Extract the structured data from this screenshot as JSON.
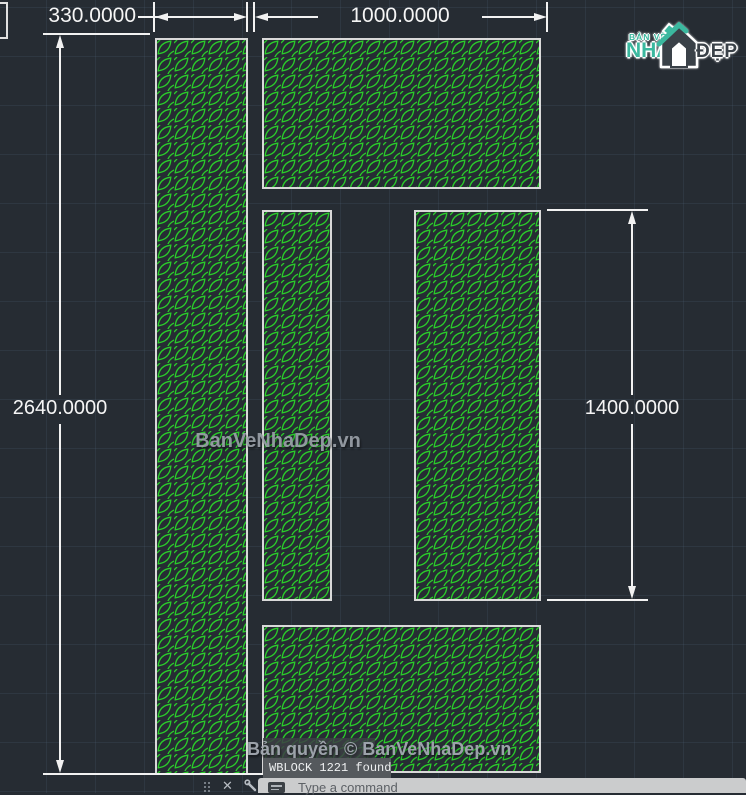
{
  "dimensions": {
    "d330": "330.0000",
    "d1000": "1000.0000",
    "d2640": "2640.0000",
    "d1400": "1400.0000"
  },
  "watermark": {
    "center": "BanVeNhaDep.vn",
    "copyright": "Bản quyền © BanVeNhaDep.vn"
  },
  "logo": {
    "top": "BẢN VẼ",
    "main": "NHÀ",
    "suffix": "ĐẸP"
  },
  "command_line": {
    "history": "WBLOCK 1221 found",
    "placeholder": "Type a command",
    "close_glyph": "✕"
  },
  "colors": {
    "canvas_bg": "#262c33",
    "leaf_green": "#2acc2a",
    "panel_border": "#d9d9d9",
    "dimension": "#f2f2f2",
    "watermark_gray": "#9aa0a8",
    "logo_teal": "#3bb89f",
    "logo_dark": "#3a4148",
    "command_input_bg": "#cbcccd"
  }
}
